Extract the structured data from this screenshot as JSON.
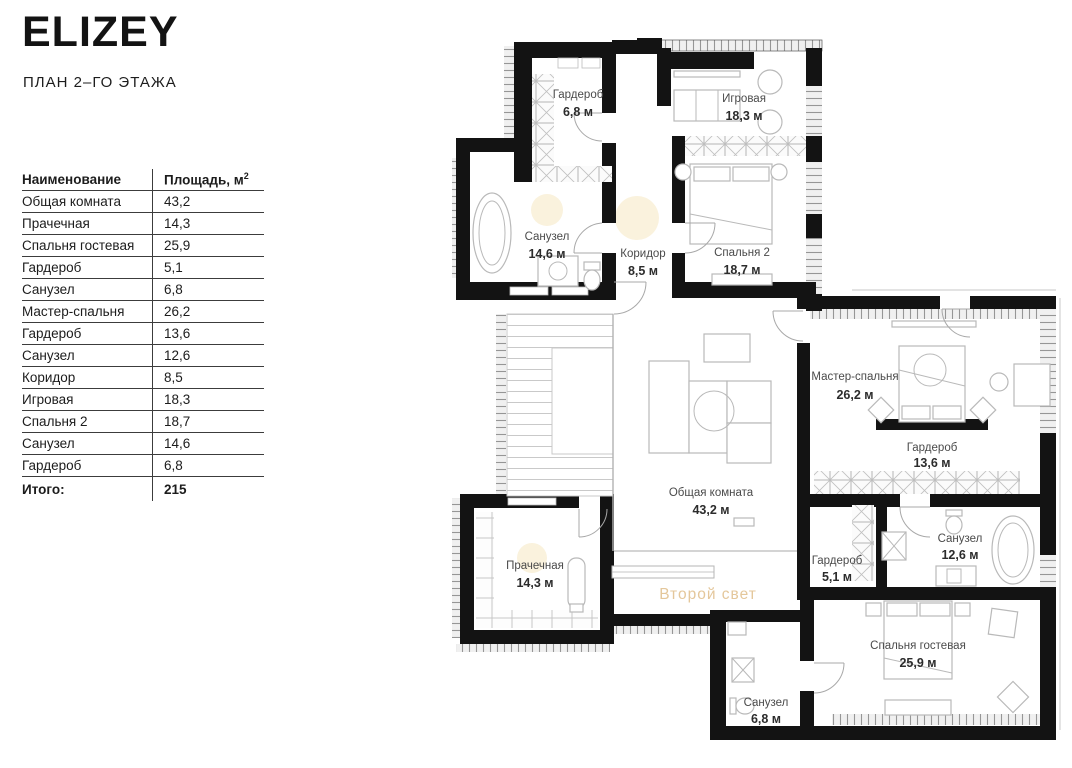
{
  "header": {
    "logo": "ELIZEY",
    "subtitle": "ПЛАН 2–ГО ЭТАЖА"
  },
  "table": {
    "col_name": "Наименование",
    "col_area": "Площадь, м",
    "col_area_sup": "2",
    "rows": [
      {
        "name": "Общая комната",
        "area": "43,2"
      },
      {
        "name": "Прачечная",
        "area": "14,3"
      },
      {
        "name": "Спальня гостевая",
        "area": "25,9"
      },
      {
        "name": "Гардероб",
        "area": "5,1"
      },
      {
        "name": "Санузел",
        "area": "6,8"
      },
      {
        "name": "Мастер-спальня",
        "area": "26,2"
      },
      {
        "name": "Гардероб",
        "area": "13,6"
      },
      {
        "name": "Санузел",
        "area": "12,6"
      },
      {
        "name": "Коридор",
        "area": "8,5"
      },
      {
        "name": "Игровая",
        "area": "18,3"
      },
      {
        "name": "Спальня 2",
        "area": "18,7"
      },
      {
        "name": "Санузел",
        "area": "14,6"
      },
      {
        "name": "Гардероб",
        "area": "6,8"
      }
    ],
    "total_label": "Итого:",
    "total_value": "215"
  },
  "plan": {
    "rooms": [
      {
        "name": "Гардероб",
        "area": "6,8 м"
      },
      {
        "name": "Игровая",
        "area": "18,3 м"
      },
      {
        "name": "Санузел",
        "area": "14,6 м"
      },
      {
        "name": "Коридор",
        "area": "8,5 м"
      },
      {
        "name": "Спальня 2",
        "area": "18,7 м"
      },
      {
        "name": "Мастер-спальня",
        "area": "26,2 м"
      },
      {
        "name": "Гардероб",
        "area": "13,6 м"
      },
      {
        "name": "Общая комната",
        "area": "43,2 м"
      },
      {
        "name": "Прачечная",
        "area": "14,3 м"
      },
      {
        "name": "Гардероб",
        "area": "5,1 м"
      },
      {
        "name": "Санузел",
        "area": "12,6 м"
      },
      {
        "name": "Спальня гостевая",
        "area": "25,9 м"
      },
      {
        "name": "Санузел",
        "area": "6,8 м"
      }
    ],
    "second_light": "Второй свет",
    "accent_color": "#e4c79b",
    "wall_color": "#131313"
  }
}
